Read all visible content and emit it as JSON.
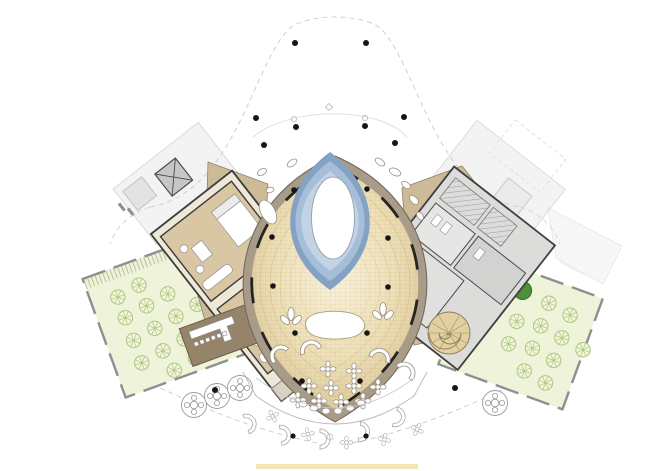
{
  "page": {
    "title": "Resort ground floor plan"
  },
  "plan": {
    "colors": {
      "lawn": "#eef3da",
      "tree_dark": "#4f8f3b",
      "pool_deep": "#84a2c4",
      "pool_mid": "#a6bed8",
      "pool_light": "#c2d3e5",
      "ring": "#a89c88",
      "plaza": "#cdbb98",
      "room_floor": "#d9c7a3",
      "deck": "#95836a",
      "slab": "#dcdcda",
      "stair": "#e3d0a0",
      "accent_strip": "#f4e2ae"
    },
    "legend": {
      "atrium": "central atrium hall",
      "pool": "oval reflecting pool",
      "oculus": "central oculus opening",
      "garden_west": "west garden courtyard",
      "garden_east": "east garden courtyard",
      "suites": "west guest suites",
      "bar_deck": "pool bar deck",
      "spiral_stair": "spiral stair",
      "terrace": "south terrace",
      "boundary": "canopy site boundary"
    },
    "counts": {
      "atrium_columns": 10,
      "site_columns": 12,
      "trees_west": 18,
      "trees_east": 12,
      "outdoor_tables": 4,
      "dining_clusters": 10
    }
  }
}
